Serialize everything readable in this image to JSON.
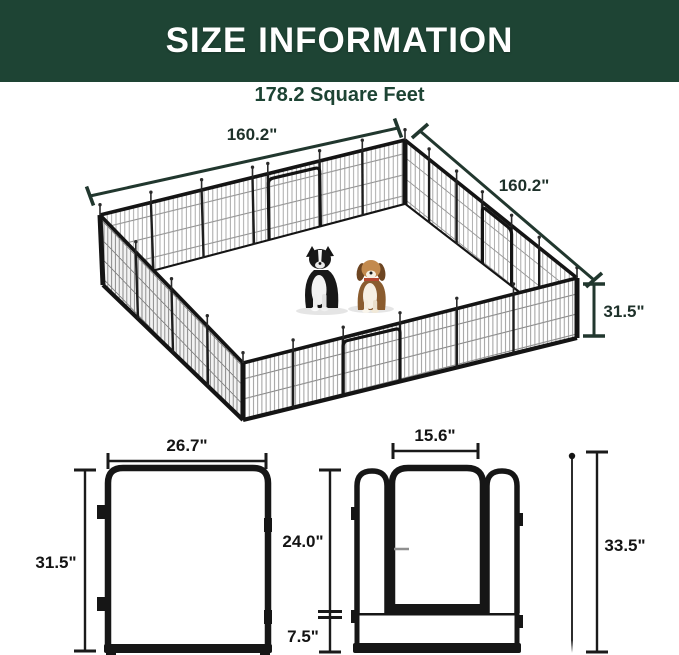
{
  "header": {
    "title": "SIZE INFORMATION"
  },
  "area_label": "178.2 Square Feet",
  "iso_view": {
    "dim_side_left": "160.2\"",
    "dim_side_right": "160.2\"",
    "dim_height": "31.5\""
  },
  "panel_diagram": {
    "dim_width": "26.7\"",
    "dim_height": "31.5\""
  },
  "door_diagram": {
    "dim_door_width": "15.6\"",
    "dim_door_height": "24.0\"",
    "dim_bottom_height": "7.5\"",
    "dim_total_height": "33.5\""
  },
  "colors": {
    "banner_green": "#1e4434",
    "dimension_green": "#21372e",
    "ink": "#1a1a1a"
  }
}
